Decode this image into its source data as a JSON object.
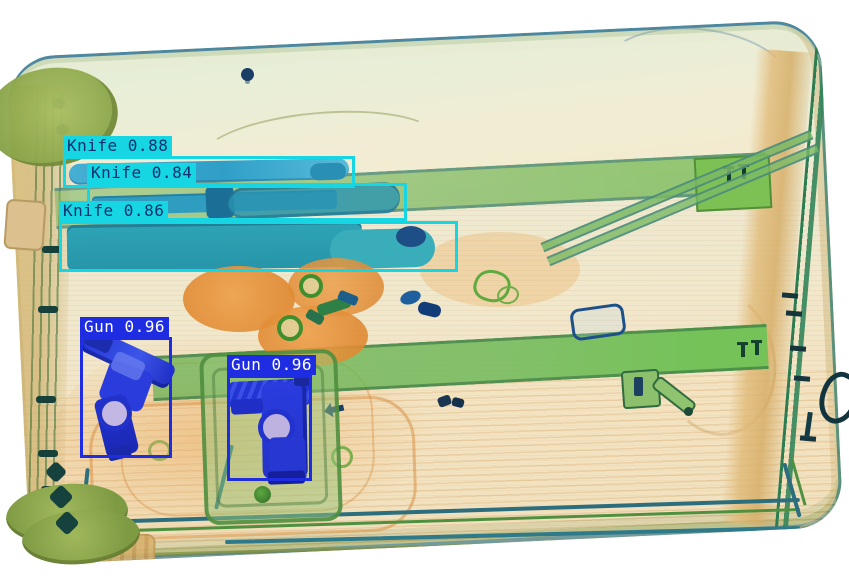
{
  "image": {
    "kind": "xray-baggage-scan",
    "width": 849,
    "height": 585
  },
  "palette": {
    "knife_box": "#15d6e2",
    "knife_text": "#0d3070",
    "gun_box": "#1e2ce2",
    "gun_text": "#ffffff",
    "background": "#ffffff"
  },
  "detections": [
    {
      "id": "knife-1",
      "label": "Knife",
      "score": "0.88",
      "display": "Knife 0.88",
      "color": "#15d6e2",
      "text_color": "#0d3070",
      "box": {
        "x": 63,
        "y": 156,
        "w": 292,
        "h": 32
      }
    },
    {
      "id": "knife-2",
      "label": "Knife",
      "score": "0.84",
      "display": "Knife 0.84",
      "color": "#15d6e2",
      "text_color": "#0d3070",
      "box": {
        "x": 87,
        "y": 183,
        "w": 320,
        "h": 38
      }
    },
    {
      "id": "knife-3",
      "label": "Knife",
      "score": "0.86",
      "display": "Knife 0.86",
      "color": "#15d6e2",
      "text_color": "#0d3070",
      "box": {
        "x": 59,
        "y": 221,
        "w": 399,
        "h": 51
      }
    },
    {
      "id": "gun-1",
      "label": "Gun",
      "score": "0.96",
      "display": "Gun 0.96",
      "color": "#1e2ce2",
      "text_color": "#ffffff",
      "box": {
        "x": 80,
        "y": 337,
        "w": 92,
        "h": 121
      }
    },
    {
      "id": "gun-2",
      "label": "Gun",
      "score": "0.96",
      "display": "Gun 0.96",
      "color": "#1e2ce2",
      "text_color": "#ffffff",
      "box": {
        "x": 227,
        "y": 375,
        "w": 85,
        "h": 106
      }
    }
  ]
}
